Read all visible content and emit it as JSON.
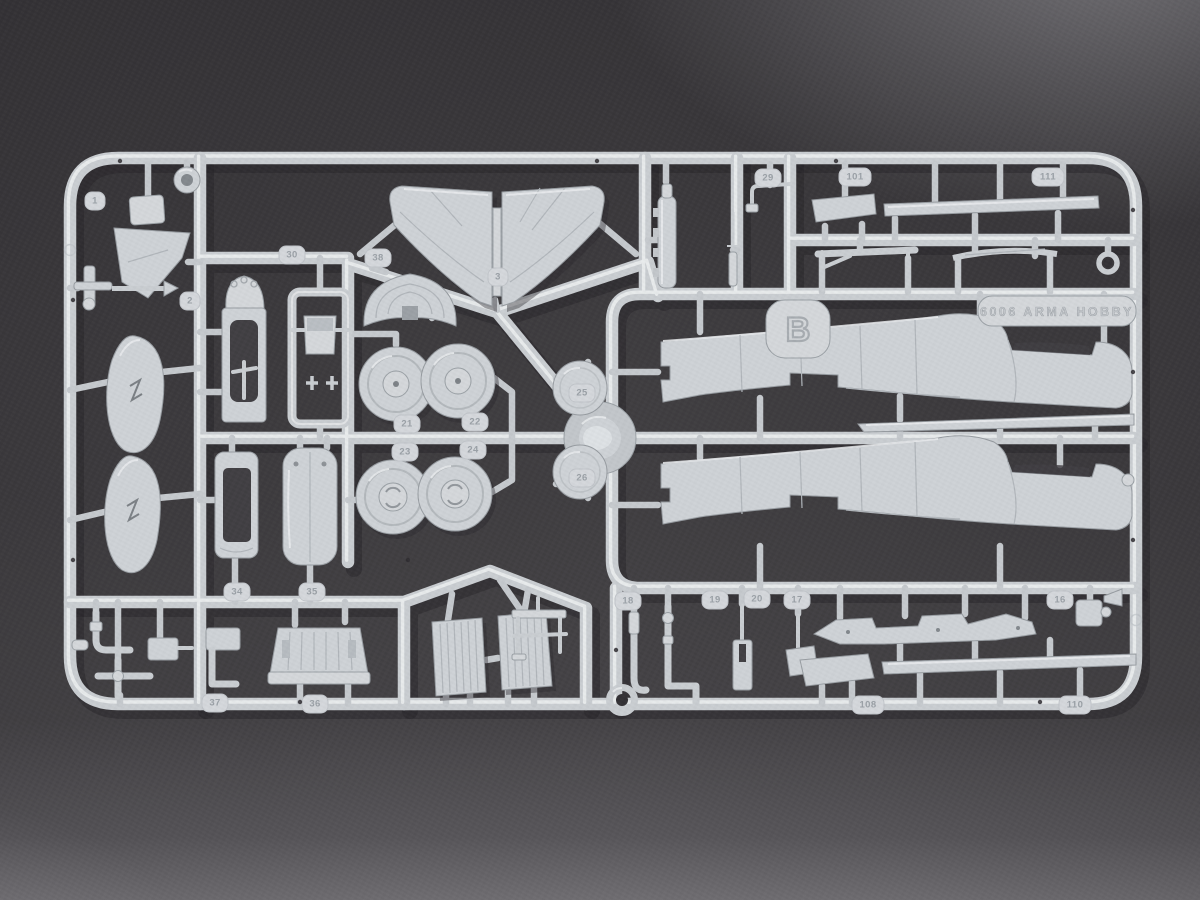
{
  "scene": {
    "description": "Light grey injection-moulded model aircraft sprue (frame B) photographed on a dark grey textured surface"
  },
  "sprue": {
    "plastic_color": "#ced2d6",
    "background_color": "#3e3c3f",
    "letter_tab": "B",
    "mold_text": "6006 ARMA HOBBY",
    "part_tags": [
      {
        "label": "1"
      },
      {
        "label": "2"
      },
      {
        "label": "29"
      },
      {
        "label": "101"
      },
      {
        "label": "111"
      },
      {
        "label": "30"
      },
      {
        "label": "38"
      },
      {
        "label": "3"
      },
      {
        "label": "21"
      },
      {
        "label": "22"
      },
      {
        "label": "23"
      },
      {
        "label": "24"
      },
      {
        "label": "25"
      },
      {
        "label": "26"
      },
      {
        "label": "34"
      },
      {
        "label": "35"
      },
      {
        "label": "37"
      },
      {
        "label": "36"
      },
      {
        "label": "18"
      },
      {
        "label": "19"
      },
      {
        "label": "20"
      },
      {
        "label": "17"
      },
      {
        "label": "16"
      },
      {
        "label": "108"
      },
      {
        "label": "110"
      }
    ]
  }
}
